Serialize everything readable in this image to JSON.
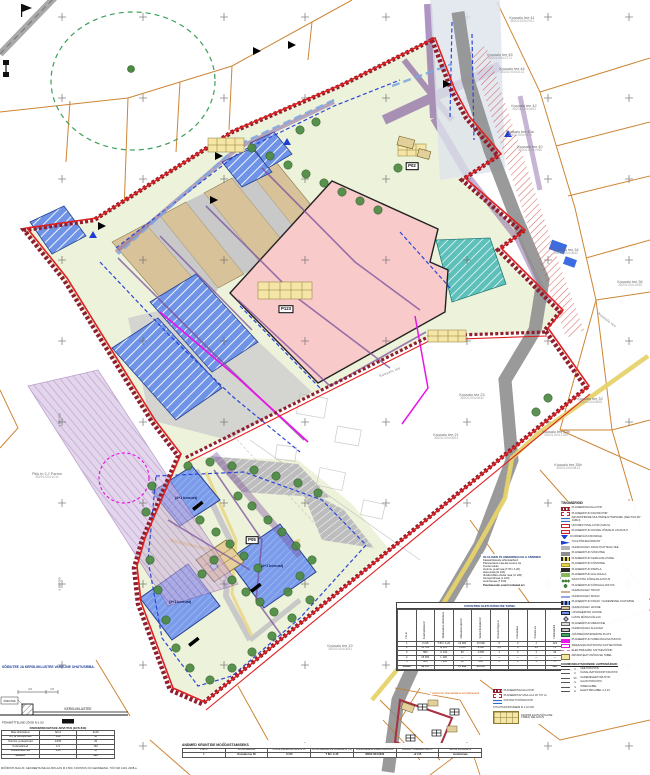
{
  "colors": {
    "boundary_red": "#8e1f2f",
    "plan_red": "#e02020",
    "parcel_orange": "#c87820",
    "building_pink": "#f8caca",
    "utility_purple": "#7a4f9b",
    "water_blue": "#2b46d8",
    "magenta": "#e814e8",
    "greenery": "#4d8a43",
    "road_gray": "#8f8f8f"
  },
  "map": {
    "pos_boxes": [
      {
        "t": "P123",
        "x": 286,
        "y": 309
      },
      {
        "t": "P05",
        "x": 252,
        "y": 540
      },
      {
        "t": "P02",
        "x": 412,
        "y": 166
      }
    ],
    "building_labels": [
      {
        "t": "(4+1 korrust)",
        "x": 186,
        "y": 498
      },
      {
        "t": "(4+1 korrust)",
        "x": 272,
        "y": 566
      },
      {
        "t": "(3+1 korrust)",
        "x": 180,
        "y": 602
      }
    ],
    "parcels": [
      {
        "n": "Kuusalu tee 41",
        "c": "35201:004:0701",
        "x": 522,
        "y": 20
      },
      {
        "n": "Kuusalu tee 45",
        "c": "35201:004:0771",
        "x": 500,
        "y": 57
      },
      {
        "n": "Kuusalu tee 44",
        "c": "35201:004:0213",
        "x": 512,
        "y": 71
      },
      {
        "n": "Kuusalu tee 42",
        "c": "35201:004:0400",
        "x": 524,
        "y": 108
      },
      {
        "n": "Kuusalu tee 43a",
        "c": "35201:004:0415",
        "x": 520,
        "y": 134
      },
      {
        "n": "Kuusalu tee 40",
        "c": "35201:004:0780",
        "x": 530,
        "y": 149
      },
      {
        "n": "Kuusalu tee 34",
        "c": "35201:004:0540",
        "x": 566,
        "y": 252
      },
      {
        "n": "Kuusalu tee 36",
        "c": "35201:004:1050",
        "x": 630,
        "y": 284
      },
      {
        "n": "Kuusalu tee 33",
        "c": "35201:004:0805",
        "x": 590,
        "y": 401
      },
      {
        "n": "Kuusalu tee 33b",
        "c": "35201:004:1780",
        "x": 556,
        "y": 434
      },
      {
        "n": "Kuusalu tee 35b",
        "c": "35201:004:0813",
        "x": 568,
        "y": 467
      },
      {
        "n": "Kuusalu tee 37",
        "c": "35201:004:0831",
        "x": 600,
        "y": 517
      },
      {
        "n": "Kuusalu tee 23",
        "c": "35201:004:0032",
        "x": 472,
        "y": 397
      },
      {
        "n": "Kuusalu tee 21",
        "c": "35201:004:0054",
        "x": 446,
        "y": 437
      },
      {
        "n": "Kuusalu tee 19",
        "c": "35201:004:0051",
        "x": 340,
        "y": 648
      },
      {
        "n": "Pikk tn 2 // Parmu",
        "c": "35201:004:1011",
        "x": 47,
        "y": 476
      }
    ],
    "street_labels": [
      {
        "t": "Kuusalu tee",
        "x": 607,
        "y": 320,
        "r": 38
      },
      {
        "t": "Kuusalu tee",
        "x": 390,
        "y": 372,
        "r": -22
      }
    ],
    "coord_labels": [
      {
        "t": "6 589 200",
        "x": 60,
        "y": 420,
        "r": -90
      },
      {
        "t": "6 589 000",
        "x": 60,
        "y": 584,
        "r": -90
      }
    ]
  },
  "notes": {
    "safety_note": "SÕIDUTEE JA KERGLIIKLUSTEE VAHELINE OHUTUSRIBA.",
    "base_note": "MÕÕDISTUSALUS: GEODEETILINE ALUSPLAAN M 1:500, KOOSTAS OÜ GEODEESIA, TÖÖ NR 1419, 2008.a."
  },
  "section": {
    "left_label": "SÕIDUTEE",
    "path_label": "KERGLIIKLUSTEE",
    "dim1": "2.0",
    "dim2": "1.5",
    "caption": "PÕHIMÕTTELINE LÕIGE M 1:50"
  },
  "parking_table": {
    "title": "PARKIMISKOHTADE ARVUTUS (EVS 843)",
    "columns": [
      "Maa sihtotstarve",
      "Norm",
      "Kohti"
    ],
    "rows": [
      [
        "Äri- ja büroopinnad",
        "1/30",
        "48"
      ],
      [
        "Tootmis- ja laopinnad",
        "1/150",
        "25"
      ],
      [
        "Korterelamud",
        "1/1",
        "140"
      ],
      [
        "Üldkasutatav ala",
        "1/10",
        "10"
      ],
      [
        "KOKKU",
        "",
        "223"
      ]
    ]
  },
  "planning_data": {
    "title": "OLULISED PLANEERINGUALA ANDMED",
    "unit_row": {
      "l": "Katastriüksuste sihtotstarbed:",
      "v1": "m²",
      "v2": "%"
    },
    "rows": [
      {
        "l": "Planeeritava maa-ala suurus ha",
        "v1": "3,7",
        "v2": ""
      },
      {
        "l": "Krunte kokku",
        "v1": "5",
        "v2": ""
      },
      {
        "l": "tootmis- ja ärimaa (T 80 / Ä 20)",
        "v1": "9 115",
        "v2": "25"
      },
      {
        "l": "elamumaa (E 100)",
        "v1": "10 728",
        "v2": "29"
      },
      {
        "l": "ühiskondliku ehitise maa (Ü 100)",
        "v1": "680",
        "v2": "2"
      },
      {
        "l": "transpordimaa (L 100)",
        "v1": "15 354",
        "v2": "42"
      },
      {
        "l": "tootmismaa (T 100)",
        "v1": "860",
        "v2": "2"
      }
    ],
    "footer_label": "Puurkaevude suurim lubatud arv",
    "footer_value": "3"
  },
  "rights_table": {
    "title": "KRUNTIDE EHITUSÕIGUSE TABEL",
    "columns": [
      "Pos nr",
      "Krundi pindala m²",
      "Maakasutuse sihtotstarve",
      "Ehitusalune pind m²",
      "Suletud brutopind m²",
      "Hoonete kõrgus m",
      "Korruselisus",
      "Hoonete arv",
      "Parkimiskohti",
      "Märkused"
    ],
    "rows": [
      [
        "1",
        "9 115",
        "T 80 / Ä 20",
        "13 000",
        "10 000",
        "6",
        "3",
        "1",
        "123",
        ""
      ],
      [
        "2",
        "10 728",
        "E 100",
        "4 180",
        "9 000",
        "2,2",
        "4",
        "14",
        "71",
        ""
      ],
      [
        "3",
        "680",
        "Ü 100",
        "60",
        "1 055",
        "1",
        "3",
        "1",
        "32",
        ""
      ],
      [
        "4",
        "15 354",
        "L 100",
        "—",
        "—",
        "—",
        "—",
        "—",
        "—",
        ""
      ],
      [
        "5",
        "860",
        "T 100",
        "50",
        "200",
        "6",
        "1",
        "1",
        "—",
        ""
      ],
      [
        "Kokku",
        "36 737",
        "",
        "17 290",
        "20 255",
        "",
        "",
        "",
        "226",
        ""
      ]
    ],
    "note": "* parkimine lahendatakse krundisiseselt"
  },
  "formation_table": {
    "title": "ANDMED KRUNTIDE MOODUSTAMISEKS",
    "columns": [
      "Pos nr",
      "Krundi aadress",
      "Krundi planeeritud suurus m²",
      "Krundi kasutamise sihtotstarve (%)",
      "Moodustatakse katastriüksustest",
      "Liidetav / eraldatav osa m²",
      "Senine sihtotstarve"
    ],
    "rows": [
      [
        "1",
        "Kuusalu tee 30",
        "9 115",
        "T 80 / Ä 20",
        "35201:004:0840",
        "+2 115",
        "tootmismaa"
      ]
    ]
  },
  "legend": {
    "title": "TINGMÄRGID",
    "items": [
      {
        "sw": "bracket-darkred",
        "label": "PLANEERINGUALA PIIR"
      },
      {
        "sw": "red-dash",
        "label": "PLANEERITUD KRUNDI PIIR"
      },
      {
        "sw": "br-blue",
        "label": "KRUNDIPIIRIDE MUUTMISE ETTEPANEK (KEHTIVA DP JÄRGI)"
      },
      {
        "sw": "red-thin",
        "label": "HOONESTUSALA PIIR (SIDUV)"
      },
      {
        "sw": "red-fill",
        "label": "PLANEERITUD HOONE VÕIMALIK ASUKOHT"
      },
      {
        "sw": "tri-blue",
        "label": "JUURDEPÄÄS KRUNDILE"
      },
      {
        "sw": "gl-blue",
        "label": "TULETÕRJEHÜDRANT"
      },
      {
        "sw": "gray",
        "label": "OLEMASOLEV ASFALTKATTEGA TEE"
      },
      {
        "sw": "dgray",
        "label": "PLANEERITUD SÕIDUTEE"
      },
      {
        "sw": "byel",
        "label": "PLANEERITUD KERGLIIKLUSTEE"
      },
      {
        "sw": "yel",
        "label": "PLANEERITUD KÕNNITEE"
      },
      {
        "sw": "blk",
        "label": "PLANEERITUD PARKLA"
      },
      {
        "sw": "grn",
        "label": "PLANEERITUD HALJASALA"
      },
      {
        "sw": "trees",
        "label": "SÄILITATAV KÕRGHALJASTUS"
      },
      {
        "sw": "tree",
        "label": "PLANEERITUD KÕRGHALJASTUS"
      },
      {
        "sw": "brown",
        "label": "OLEMASOLEV TRUUP"
      },
      {
        "sw": "wavy",
        "label": "OLEMASOLEV KRAAV"
      },
      {
        "sw": "bblue",
        "label": "PLANEERITUD KRAAV / SADEMEVEE JUHTIMINE"
      },
      {
        "sw": "tan",
        "label": "OLEMASOLEV HOONE"
      },
      {
        "sw": "blue",
        "label": "LIKVIDEERITAV HOONE"
      },
      {
        "sw": "diam",
        "label": "LASTE MÄNGUVÄLJAK"
      },
      {
        "sw": "gray2",
        "label": "PLANEERITUD ABIHOONE"
      },
      {
        "sw": "win",
        "label": "OLEMASOLEV ALAJAAM"
      },
      {
        "sw": "grn2",
        "label": "JÄÄTMEKONTEINERITE PLATS"
      },
      {
        "sw": "mag",
        "label": "PLANEERITUD SIDEKANALISATSIOON"
      },
      {
        "sw": "mag-o",
        "label": "SIDEKANALISATSIOONI KAITSEVÖÖND"
      },
      {
        "sw": "pink",
        "label": "ELEKTRIKAABLI KAITSEVÖÖND"
      },
      {
        "sw": "sample",
        "label": "KRUNDI EHITUSÕIGUSE TABEL"
      }
    ],
    "utilities_title": "KOMMUNIKATSIOONIDE LEPPEMÄRGID:",
    "utilities": [
      {
        "code": "V",
        "label": "VEETORUSTIK"
      },
      {
        "code": "K",
        "label": "KANALISATSIOONITORUSTIK"
      },
      {
        "code": "SK",
        "label": "SADEMEVEETORUSTIK"
      },
      {
        "code": "G",
        "label": "GAASITORUSTIK"
      },
      {
        "code": "S",
        "label": "SIDEKAABEL"
      },
      {
        "code": "E",
        "label": "ELEKTRIKAABEL 0,4 kV"
      }
    ]
  },
  "mini_legend": {
    "items": [
      {
        "sw": "bracket-darkred",
        "label": "PLANEERINGUALA PIIR"
      },
      {
        "sw": "red-dash",
        "label": "PLANEERITAV MAA-ALA 36 737 m²"
      },
      {
        "sw": "br-blue",
        "label": "KONTAKTVÖÖNDI PIIR"
      }
    ],
    "caption": "SITUATSIOONISKEEM M 1:10 000",
    "sample_caption": "KRUNDI EHITUSÕIGUSE TABELI SELGITUS"
  }
}
